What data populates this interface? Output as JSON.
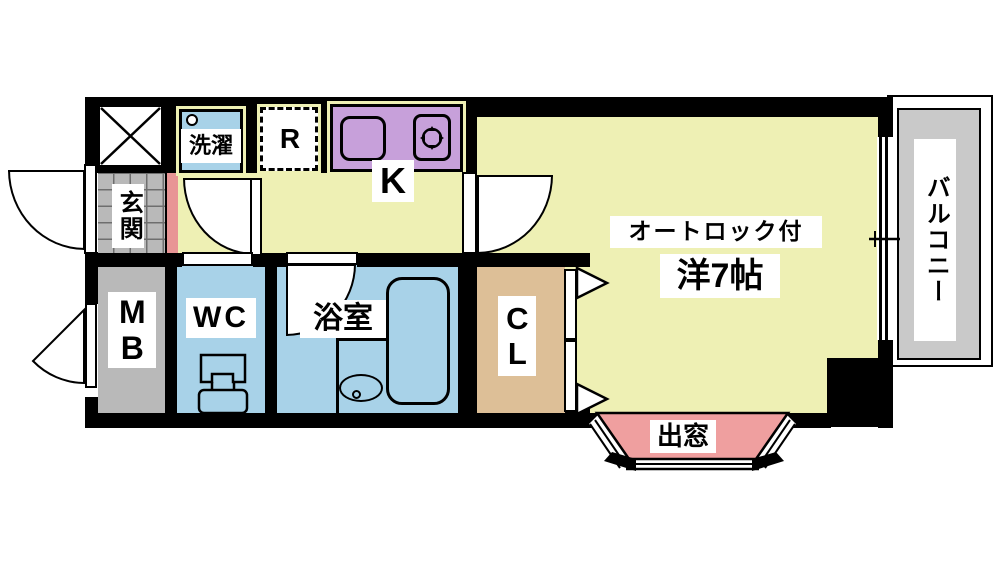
{
  "floorplan": {
    "type": "apartment-floor-plan",
    "labels": {
      "laundry": "洗濯",
      "refrigerator": "R",
      "kitchen": "K",
      "entrance": "玄関",
      "autolock": "オートロック付",
      "main_room": "洋7帖",
      "meter_box": "MB",
      "toilet": "WC",
      "bathroom": "浴室",
      "closet": "CL",
      "bay_window": "出窓",
      "balcony": "バルコニー"
    },
    "colors": {
      "floor_yellow": "#eef0b4",
      "wet_area_blue": "#a8d2e8",
      "kitchen_counter_purple": "#c7a0da",
      "closet_tan": "#ddbf97",
      "bay_window_pink": "#ef9f9f",
      "entrance_step_pink": "#e89595",
      "entrance_gray": "#b9b9b9",
      "balcony_gray": "#c9c9c9",
      "wall_black": "#000000"
    }
  }
}
